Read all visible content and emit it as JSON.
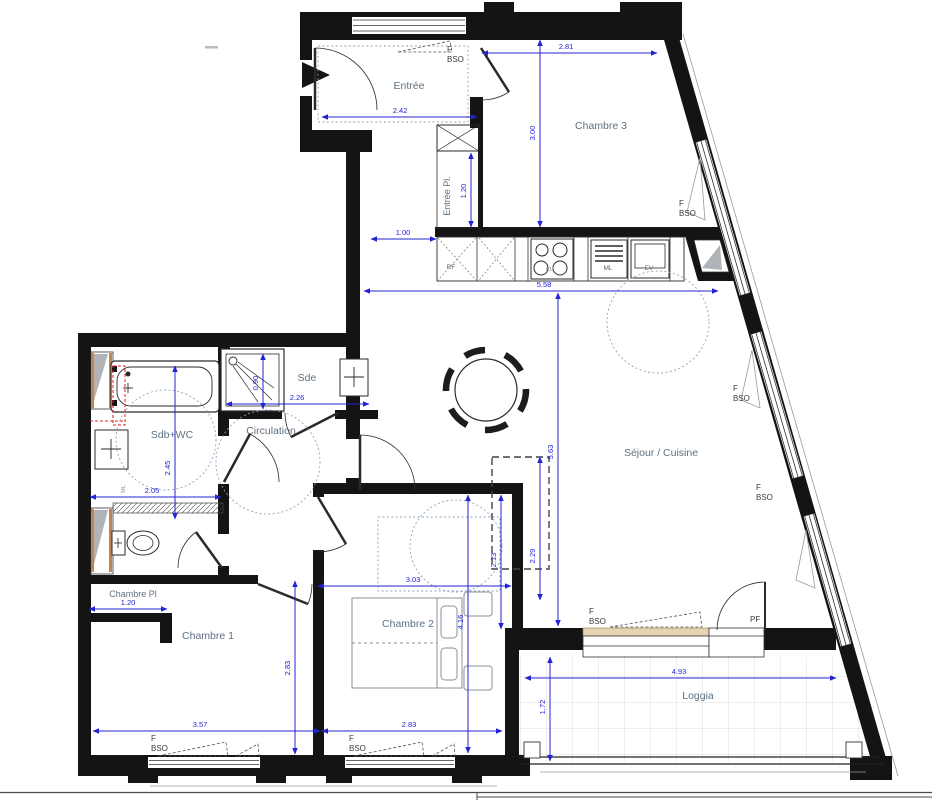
{
  "meta": {
    "drawing_type": "apartment floor plan"
  },
  "colors": {
    "wall": "#141414",
    "dimension_blue": "#2323d6",
    "room_label": "#5d7080",
    "annotation": "#3a3a3a",
    "guide_dashed": "#8fa3bd",
    "window_tan": "#e7d3b4",
    "red_overlay": "#e02020"
  },
  "rooms": {
    "entree": "Entrée",
    "entree_pl": "Entrée Pl.",
    "chambre3": "Chambre 3",
    "sejour": "Séjour / Cuisine",
    "sdb": "Sdb+WC",
    "sde": "Sde",
    "circulation": "Circulation",
    "chambre_pl": "Chambre Pl",
    "chambre1": "Chambre 1",
    "chambre2": "Chambre 2",
    "loggia": "Loggia"
  },
  "dimensions": {
    "d242": "2.42",
    "d281": "2.81",
    "d300": "3.00",
    "d120_closet": "1.20",
    "d100": "1.00",
    "d558": "5.58",
    "d563": "5.63",
    "d090": "0.90",
    "d226": "2.26",
    "d205": "2.05",
    "d245": "2.45",
    "d120_pl": "1.20",
    "d357": "3.57",
    "d283_w": "2.83",
    "d283_h": "2.83",
    "d303": "3.03",
    "d416": "4.16",
    "d213": "2.13",
    "d229": "2.29",
    "d493": "4.93",
    "d172": "1.72"
  },
  "labels": {
    "f": "F",
    "bso": "BSO",
    "pf": "PF"
  },
  "appliances": {
    "rf": "RF",
    "cu": "CU",
    "ml": "ML",
    "ev": "EV",
    "laundry": "ML"
  }
}
